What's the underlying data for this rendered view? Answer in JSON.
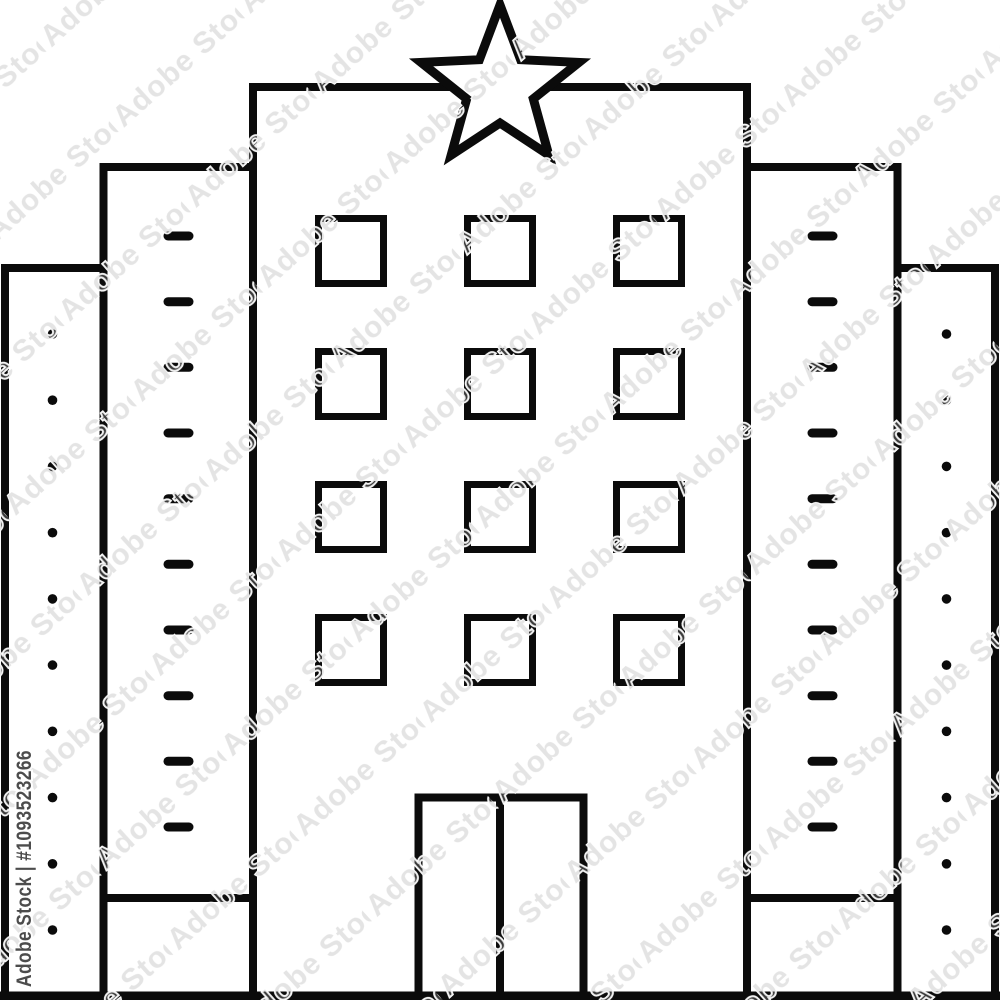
{
  "image": {
    "description": "Hotel building line icon with star on top, three-by-four window grid, double door, stepped side wings with dash and dot details",
    "background_color": "#ffffff"
  },
  "watermark": {
    "tile_text": "Adobe Stock",
    "id_text": "Adobe Stock | #1093523266",
    "tile_color": "#a6a6a6",
    "id_color": "#3d3d3d"
  },
  "icon": {
    "stroke_color": "#0b0b0b",
    "fill_color": "#ffffff",
    "star_points": 5,
    "window_rows": 4,
    "window_cols": 3,
    "door_panels": 2,
    "dashes_per_inner_wing": 10,
    "dots_per_outer_wing": 10
  }
}
